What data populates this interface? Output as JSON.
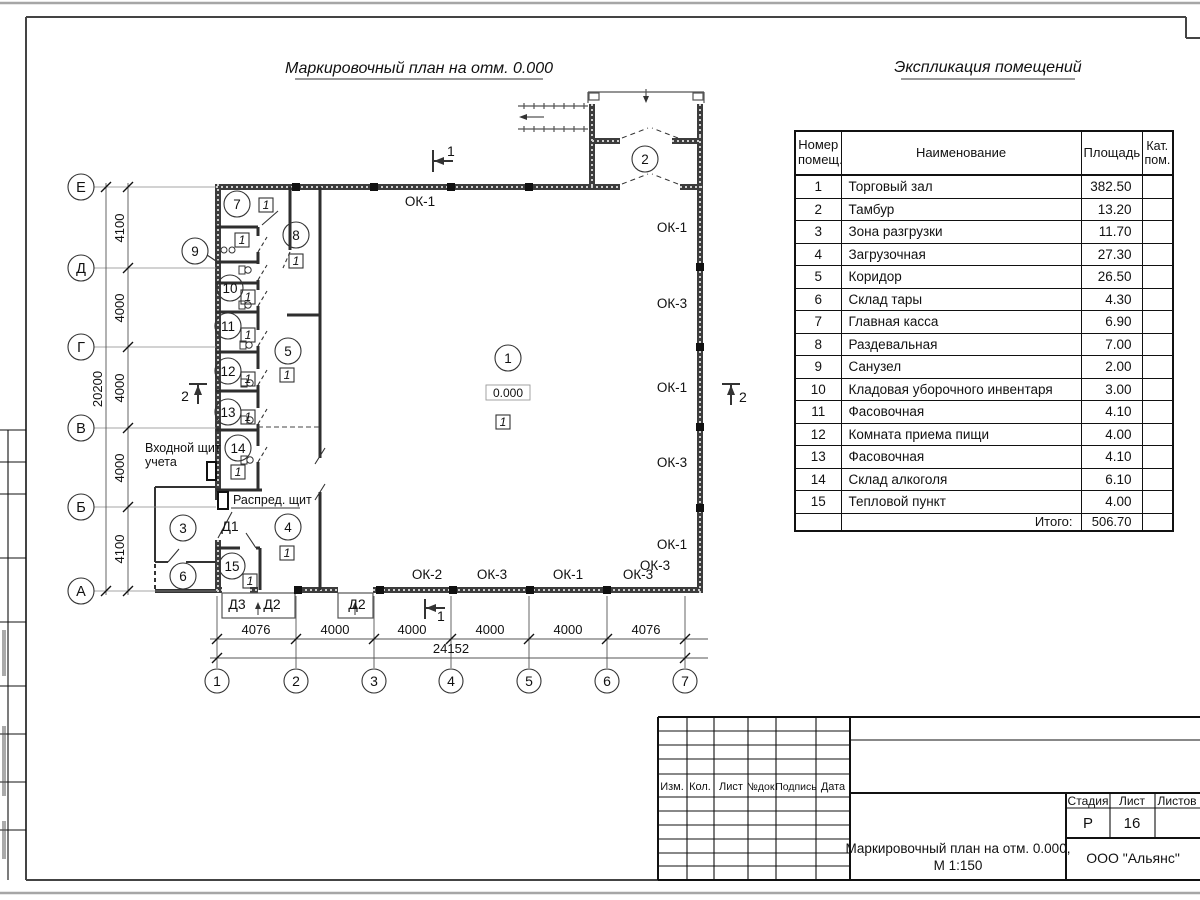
{
  "page": {
    "plan_title": "Маркировочный план на отм. 0.000",
    "explication_title": "Экспликация помещений"
  },
  "plan": {
    "marker": "1",
    "elevation": "0.000",
    "rooms": {
      "r1": "1",
      "r2": "2",
      "r3": "3",
      "r4": "4",
      "r5": "5",
      "r6": "6",
      "r7": "7",
      "r8": "8",
      "r9": "9",
      "r10": "10",
      "r11": "11",
      "r12": "12",
      "r13": "13",
      "r14": "14",
      "r15": "15"
    },
    "windows": {
      "top": "ОК-1",
      "right1": "ОК-1",
      "right2": "ОК-3",
      "right3": "ОК-1",
      "right4": "ОК-3",
      "right5": "ОК-1",
      "right6": "ОК-3",
      "bottom1": "ОК-2",
      "bottom2": "ОК-3",
      "bottom3": "ОК-1",
      "bottom4": "ОК-3"
    },
    "doors": {
      "d1": "Д1",
      "d3": "Д3",
      "d2a": "Д2",
      "d2b": "Д2"
    },
    "labels": {
      "entry_board_line1": "Входной щит",
      "entry_board_line2": "учета",
      "distribution_board": "Распред. щит"
    },
    "sections": {
      "s1": "1",
      "s2": "2"
    },
    "axes": {
      "rows": [
        "Е",
        "Д",
        "Г",
        "В",
        "Б",
        "А"
      ],
      "cols": [
        "1",
        "2",
        "3",
        "4",
        "5",
        "6",
        "7"
      ]
    },
    "dims": {
      "v1": "4100",
      "v2": "4000",
      "v3": "4000",
      "v4": "4000",
      "v5": "4100",
      "v_total": "20200",
      "h1": "4076",
      "h2": "4000",
      "h3": "4000",
      "h4": "4000",
      "h5": "4000",
      "h6": "4076",
      "h_total": "24152"
    }
  },
  "explication": {
    "headers": {
      "num": "Номер помещ.",
      "name": "Наименование",
      "area": "Площадь",
      "cat": "Кат. пом."
    },
    "rows": [
      {
        "num": "1",
        "name": "Торговый зал",
        "area": "382.50"
      },
      {
        "num": "2",
        "name": "Тамбур",
        "area": "13.20"
      },
      {
        "num": "3",
        "name": "Зона разгрузки",
        "area": "11.70"
      },
      {
        "num": "4",
        "name": "Загрузочная",
        "area": "27.30"
      },
      {
        "num": "5",
        "name": "Коридор",
        "area": "26.50"
      },
      {
        "num": "6",
        "name": "Склад тары",
        "area": "4.30"
      },
      {
        "num": "7",
        "name": "Главная касса",
        "area": "6.90"
      },
      {
        "num": "8",
        "name": "Раздевальная",
        "area": "7.00"
      },
      {
        "num": "9",
        "name": "Санузел",
        "area": "2.00"
      },
      {
        "num": "10",
        "name": "Кладовая уборочного инвентаря",
        "area": "3.00"
      },
      {
        "num": "11",
        "name": "Фасовочная",
        "area": "4.10"
      },
      {
        "num": "12",
        "name": "Комната приема пищи",
        "area": "4.00"
      },
      {
        "num": "13",
        "name": "Фасовочная",
        "area": "4.10"
      },
      {
        "num": "14",
        "name": "Склад алкоголя",
        "area": "6.10"
      },
      {
        "num": "15",
        "name": "Тепловой пункт",
        "area": "4.00"
      }
    ],
    "total_label": "Итого:",
    "total_value": "506.70"
  },
  "titleblock": {
    "col_headers": [
      "Изм.",
      "Кол.",
      "Лист",
      "№док.",
      "Подпись",
      "Дата"
    ],
    "stage_label": "Стадия",
    "sheet_label": "Лист",
    "sheets_label": "Листов",
    "stage_value": "Р",
    "sheet_value": "16",
    "doc_title_line1": "Маркировочный план на отм. 0.000,",
    "doc_title_line2": "М 1:150",
    "company": "ООО \"Альянс\""
  }
}
